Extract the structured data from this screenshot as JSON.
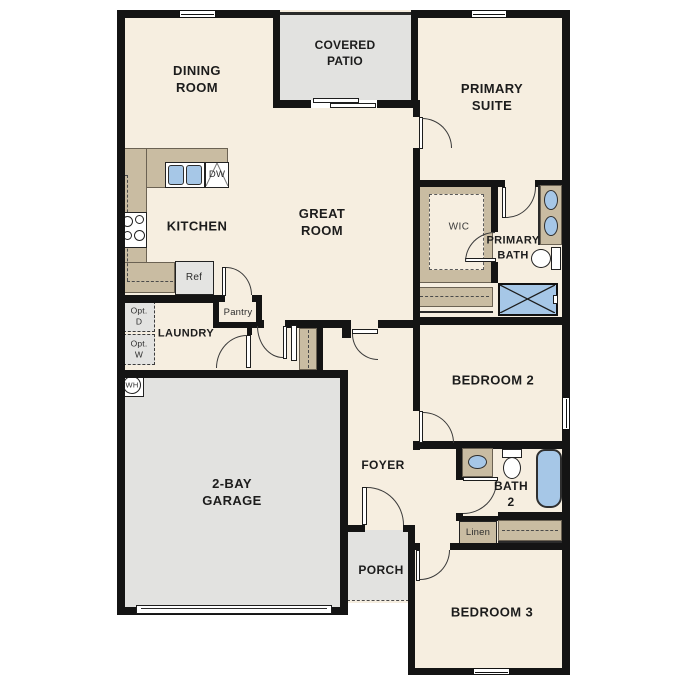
{
  "plan": {
    "type": "single-story floor plan",
    "colors": {
      "floor": "#f6eee0",
      "wall": "#141414",
      "casework_tan": "#c9bca2",
      "slab_grey": "#e2e2e0",
      "fixture_blue": "#a6c7e7",
      "text": "#1c1c1c"
    },
    "rooms": {
      "dining": "DINING\nROOM",
      "patio": "COVERED\nPATIO",
      "primary_suite": "PRIMARY\nSUITE",
      "kitchen": "KITCHEN",
      "great_room": "GREAT\nROOM",
      "laundry": "LAUNDRY",
      "wic": "WIC",
      "primary_bath": "PRIMARY\nBATH",
      "bedroom2": "BEDROOM 2",
      "foyer": "FOYER",
      "bath2": "BATH\n2",
      "garage": "2-BAY\nGARAGE",
      "porch": "PORCH",
      "bedroom3": "BEDROOM 3"
    },
    "fixtures": {
      "dishwasher": "DW",
      "refrigerator": "Ref",
      "pantry": "Pantry",
      "optional_dryer": "Opt.\nD",
      "optional_washer": "Opt.\nW",
      "water_heater": "WH",
      "linen": "Linen"
    }
  }
}
